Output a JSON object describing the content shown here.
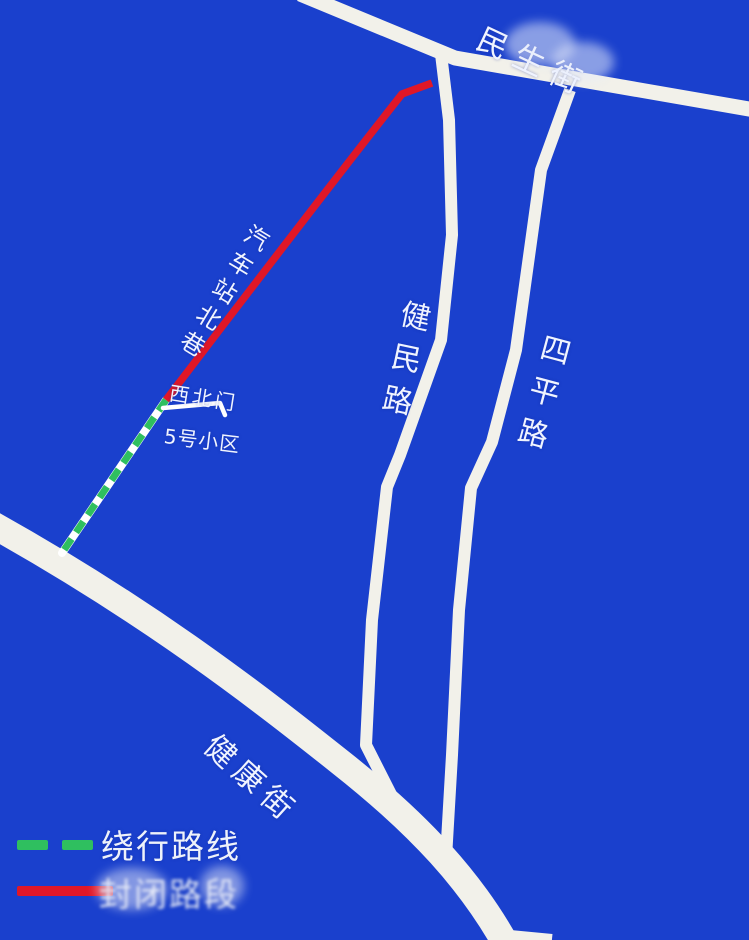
{
  "colors": {
    "background": "#1a40cd",
    "road": "#f2f1ea",
    "detour-green": "#2fbf5f",
    "closed-red": "#e01727",
    "label-text": "#f0f4ff"
  },
  "map": {
    "road_labels": {
      "minsheng_street": "民生街",
      "jianmin_road": "健民路",
      "siping_road": "四平路",
      "jiankang_street": "健康街",
      "qiche_north_alley": "汽车站北巷"
    },
    "place_labels": {
      "northwest_gate": "西北门",
      "community_5": "5号小区"
    }
  },
  "legend": {
    "detour_label": "绕行路线",
    "closed_label": "封闭路段"
  }
}
